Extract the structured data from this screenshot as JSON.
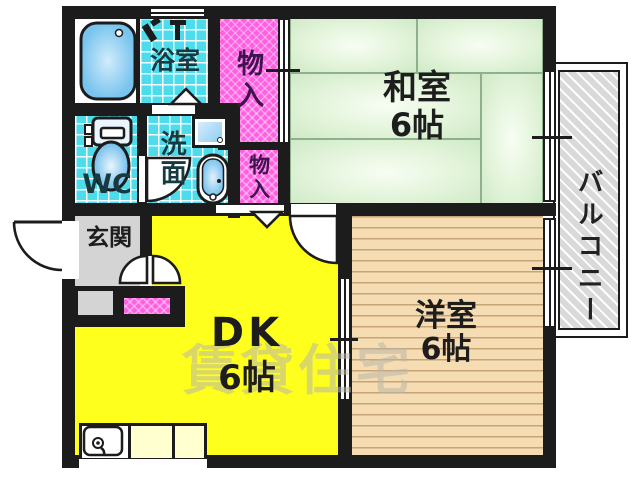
{
  "rooms": {
    "bathroom": {
      "label": "浴室"
    },
    "storage_top": {
      "label": "物入"
    },
    "storage_mid": {
      "label": "物入"
    },
    "wc": {
      "label": "WC"
    },
    "washroom": {
      "label": "洗面"
    },
    "entrance": {
      "label": "玄関"
    },
    "japanese_room": {
      "label": "和室",
      "size": "6帖"
    },
    "western_room": {
      "label": "洋室",
      "size": "6帖"
    },
    "dining_kitchen": {
      "label": "DK",
      "size": "6帖"
    },
    "balcony": {
      "label": "バルコニー"
    }
  },
  "watermark": "賃貸住宅",
  "colors": {
    "wall": "#1c1c1c",
    "tatami_green": "#cfeac6",
    "dk_yellow": "#ffff1e",
    "tile_cyan": "#4cdcec",
    "storage_magenta": "#ff5fe0",
    "wood_tan": "#f6dcb2",
    "entrance_gray": "#d4d4d4",
    "balcony_gray": "#d9d9d9",
    "counter_cream": "#ffffd0"
  }
}
